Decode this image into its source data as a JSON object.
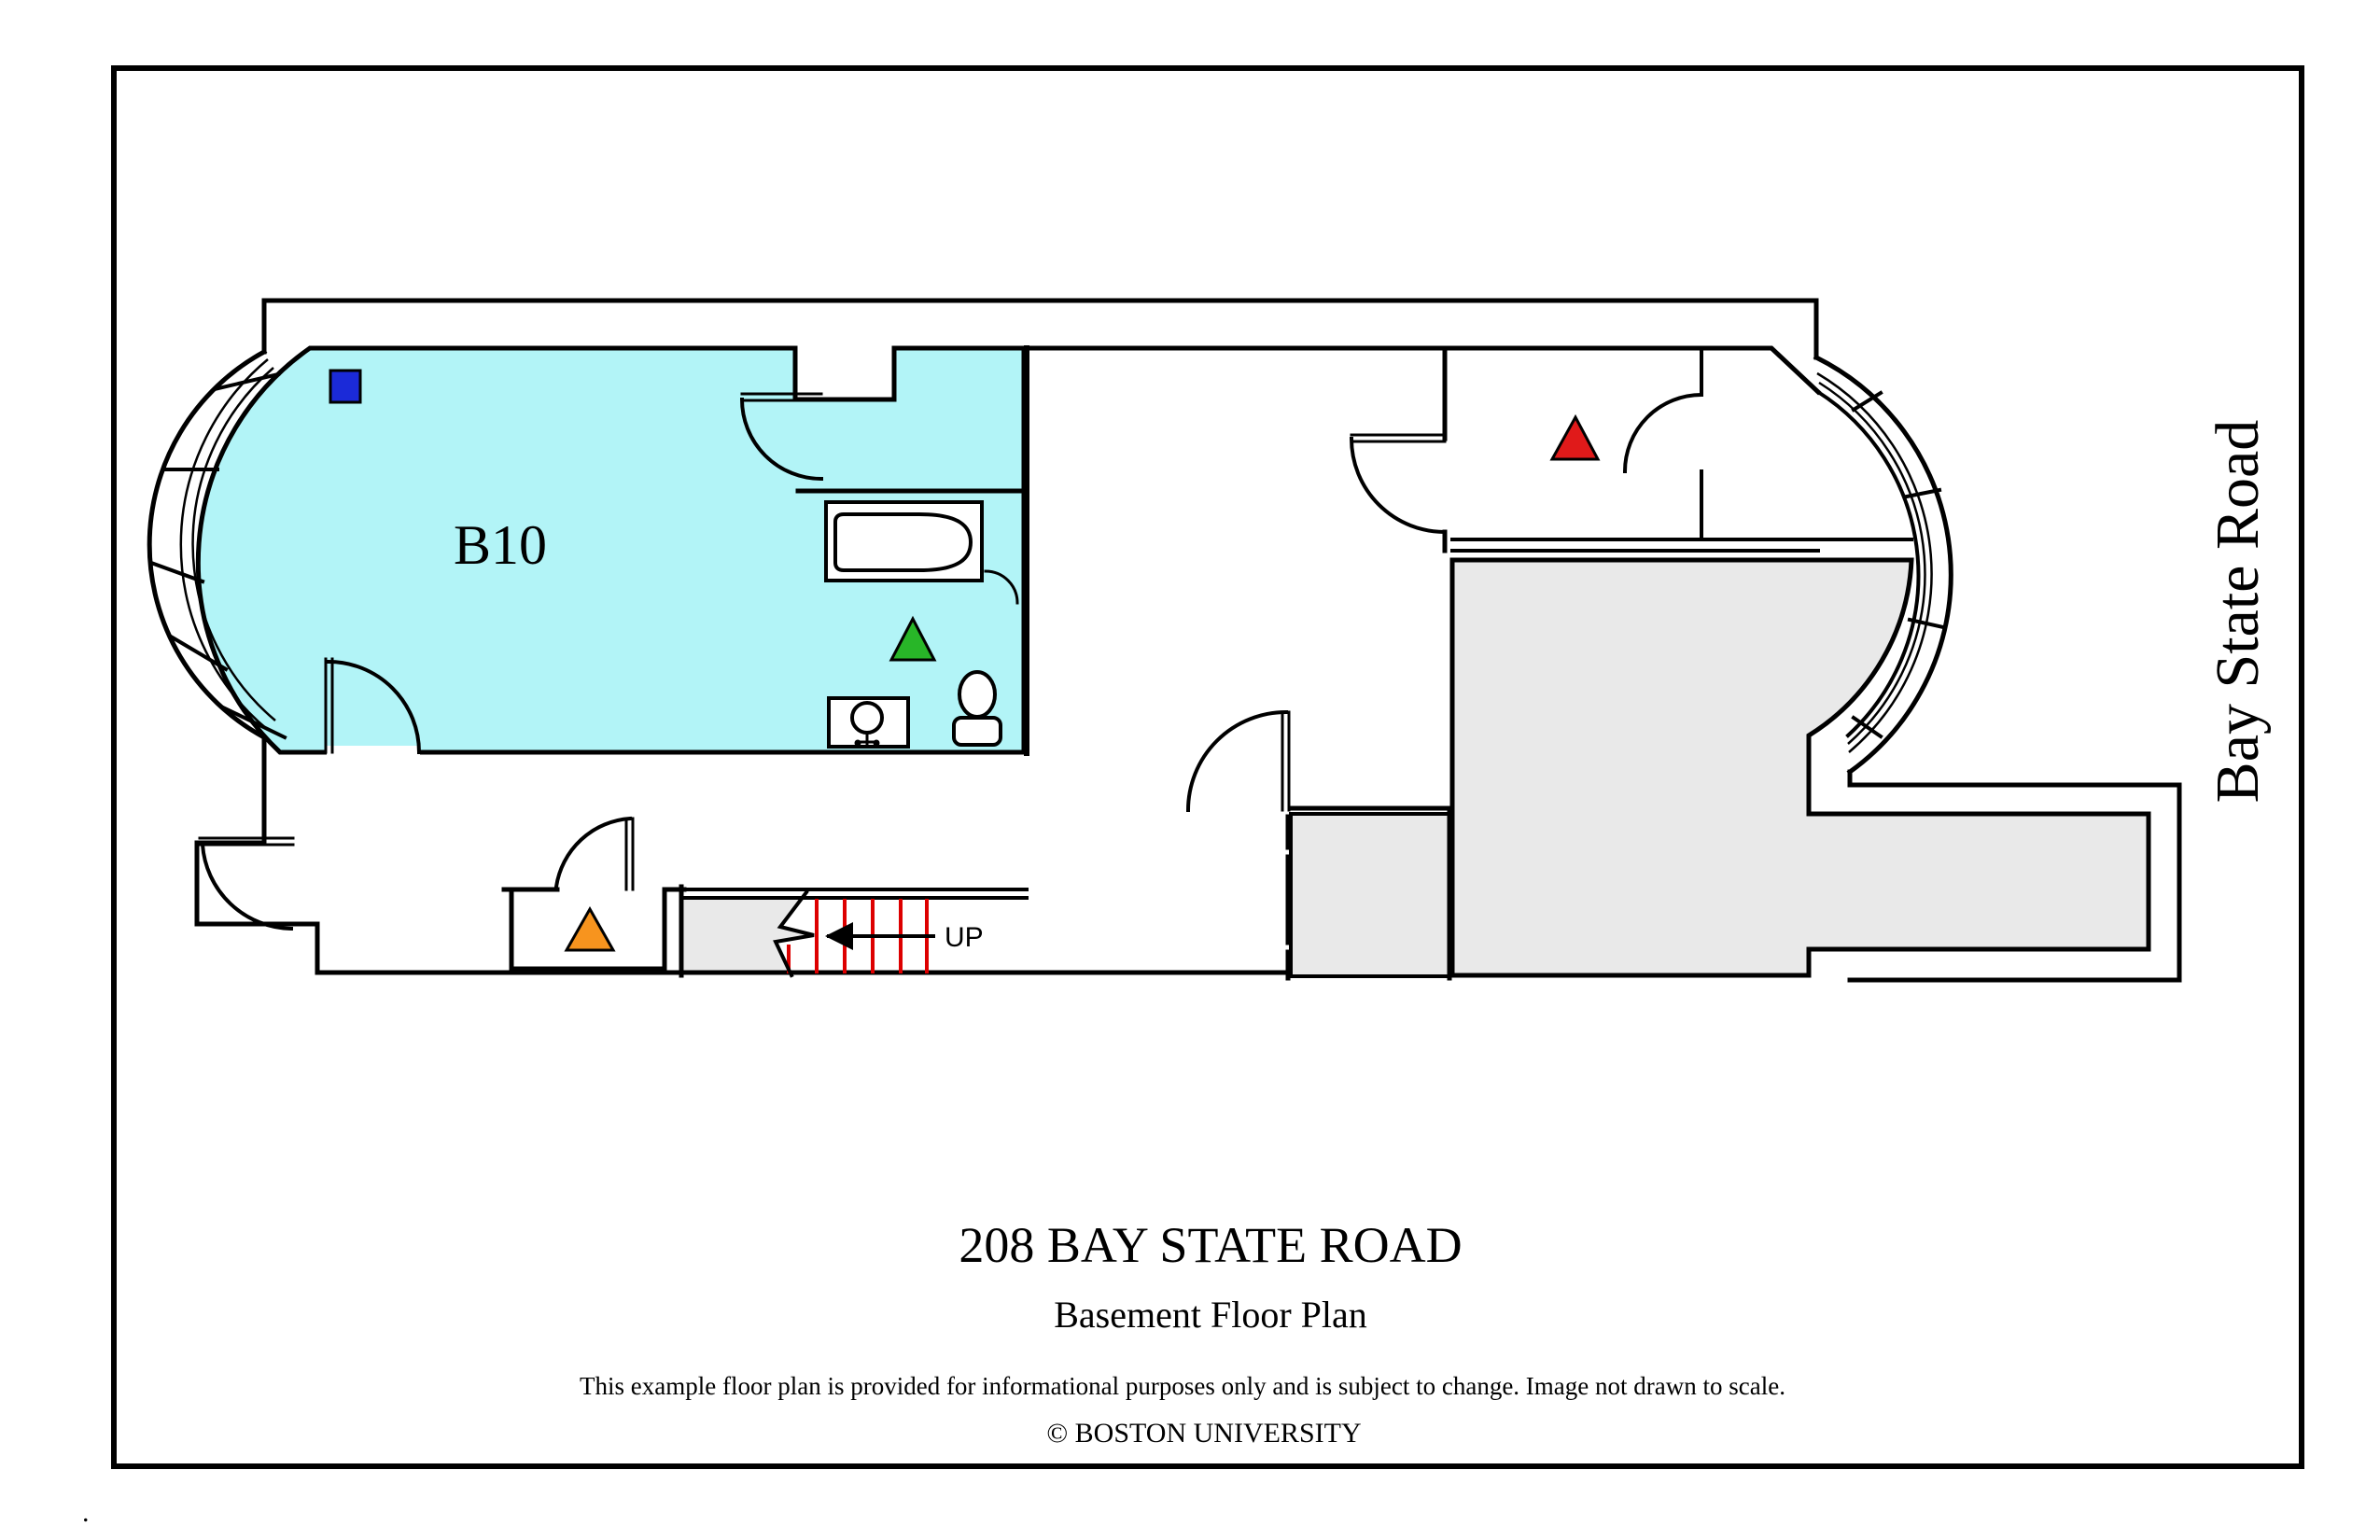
{
  "plan": {
    "room_label": "B10",
    "stairs_label": "UP",
    "street_label": "Bay State Road",
    "colors": {
      "room_fill": "#b2f4f7",
      "excluded_fill": "#e9e9e9",
      "stair_tread": "#dd0000",
      "marker_blue": "#1b2ad8",
      "marker_green": "#28b628",
      "marker_red": "#e01a1a",
      "marker_orange": "#f7941e",
      "wall": "#000000"
    },
    "markers": [
      {
        "shape": "square",
        "color_name": "blue",
        "location": "room B10 north-west corner"
      },
      {
        "shape": "triangle",
        "color_name": "green",
        "location": "bathroom of room B10"
      },
      {
        "shape": "triangle",
        "color_name": "red",
        "location": "rear right room"
      },
      {
        "shape": "triangle",
        "color_name": "orange",
        "location": "hallway alcove"
      }
    ],
    "fixtures": [
      "bathtub",
      "toilet",
      "sink"
    ]
  },
  "titleblock": {
    "address": "208 BAY STATE ROAD",
    "plan_name": "Basement Floor Plan",
    "disclaimer": "This example floor plan is provided for informational purposes only and is subject to change. Image not drawn to scale.",
    "copyright": "© BOSTON UNIVERSITY"
  },
  "artifact_dot": "."
}
